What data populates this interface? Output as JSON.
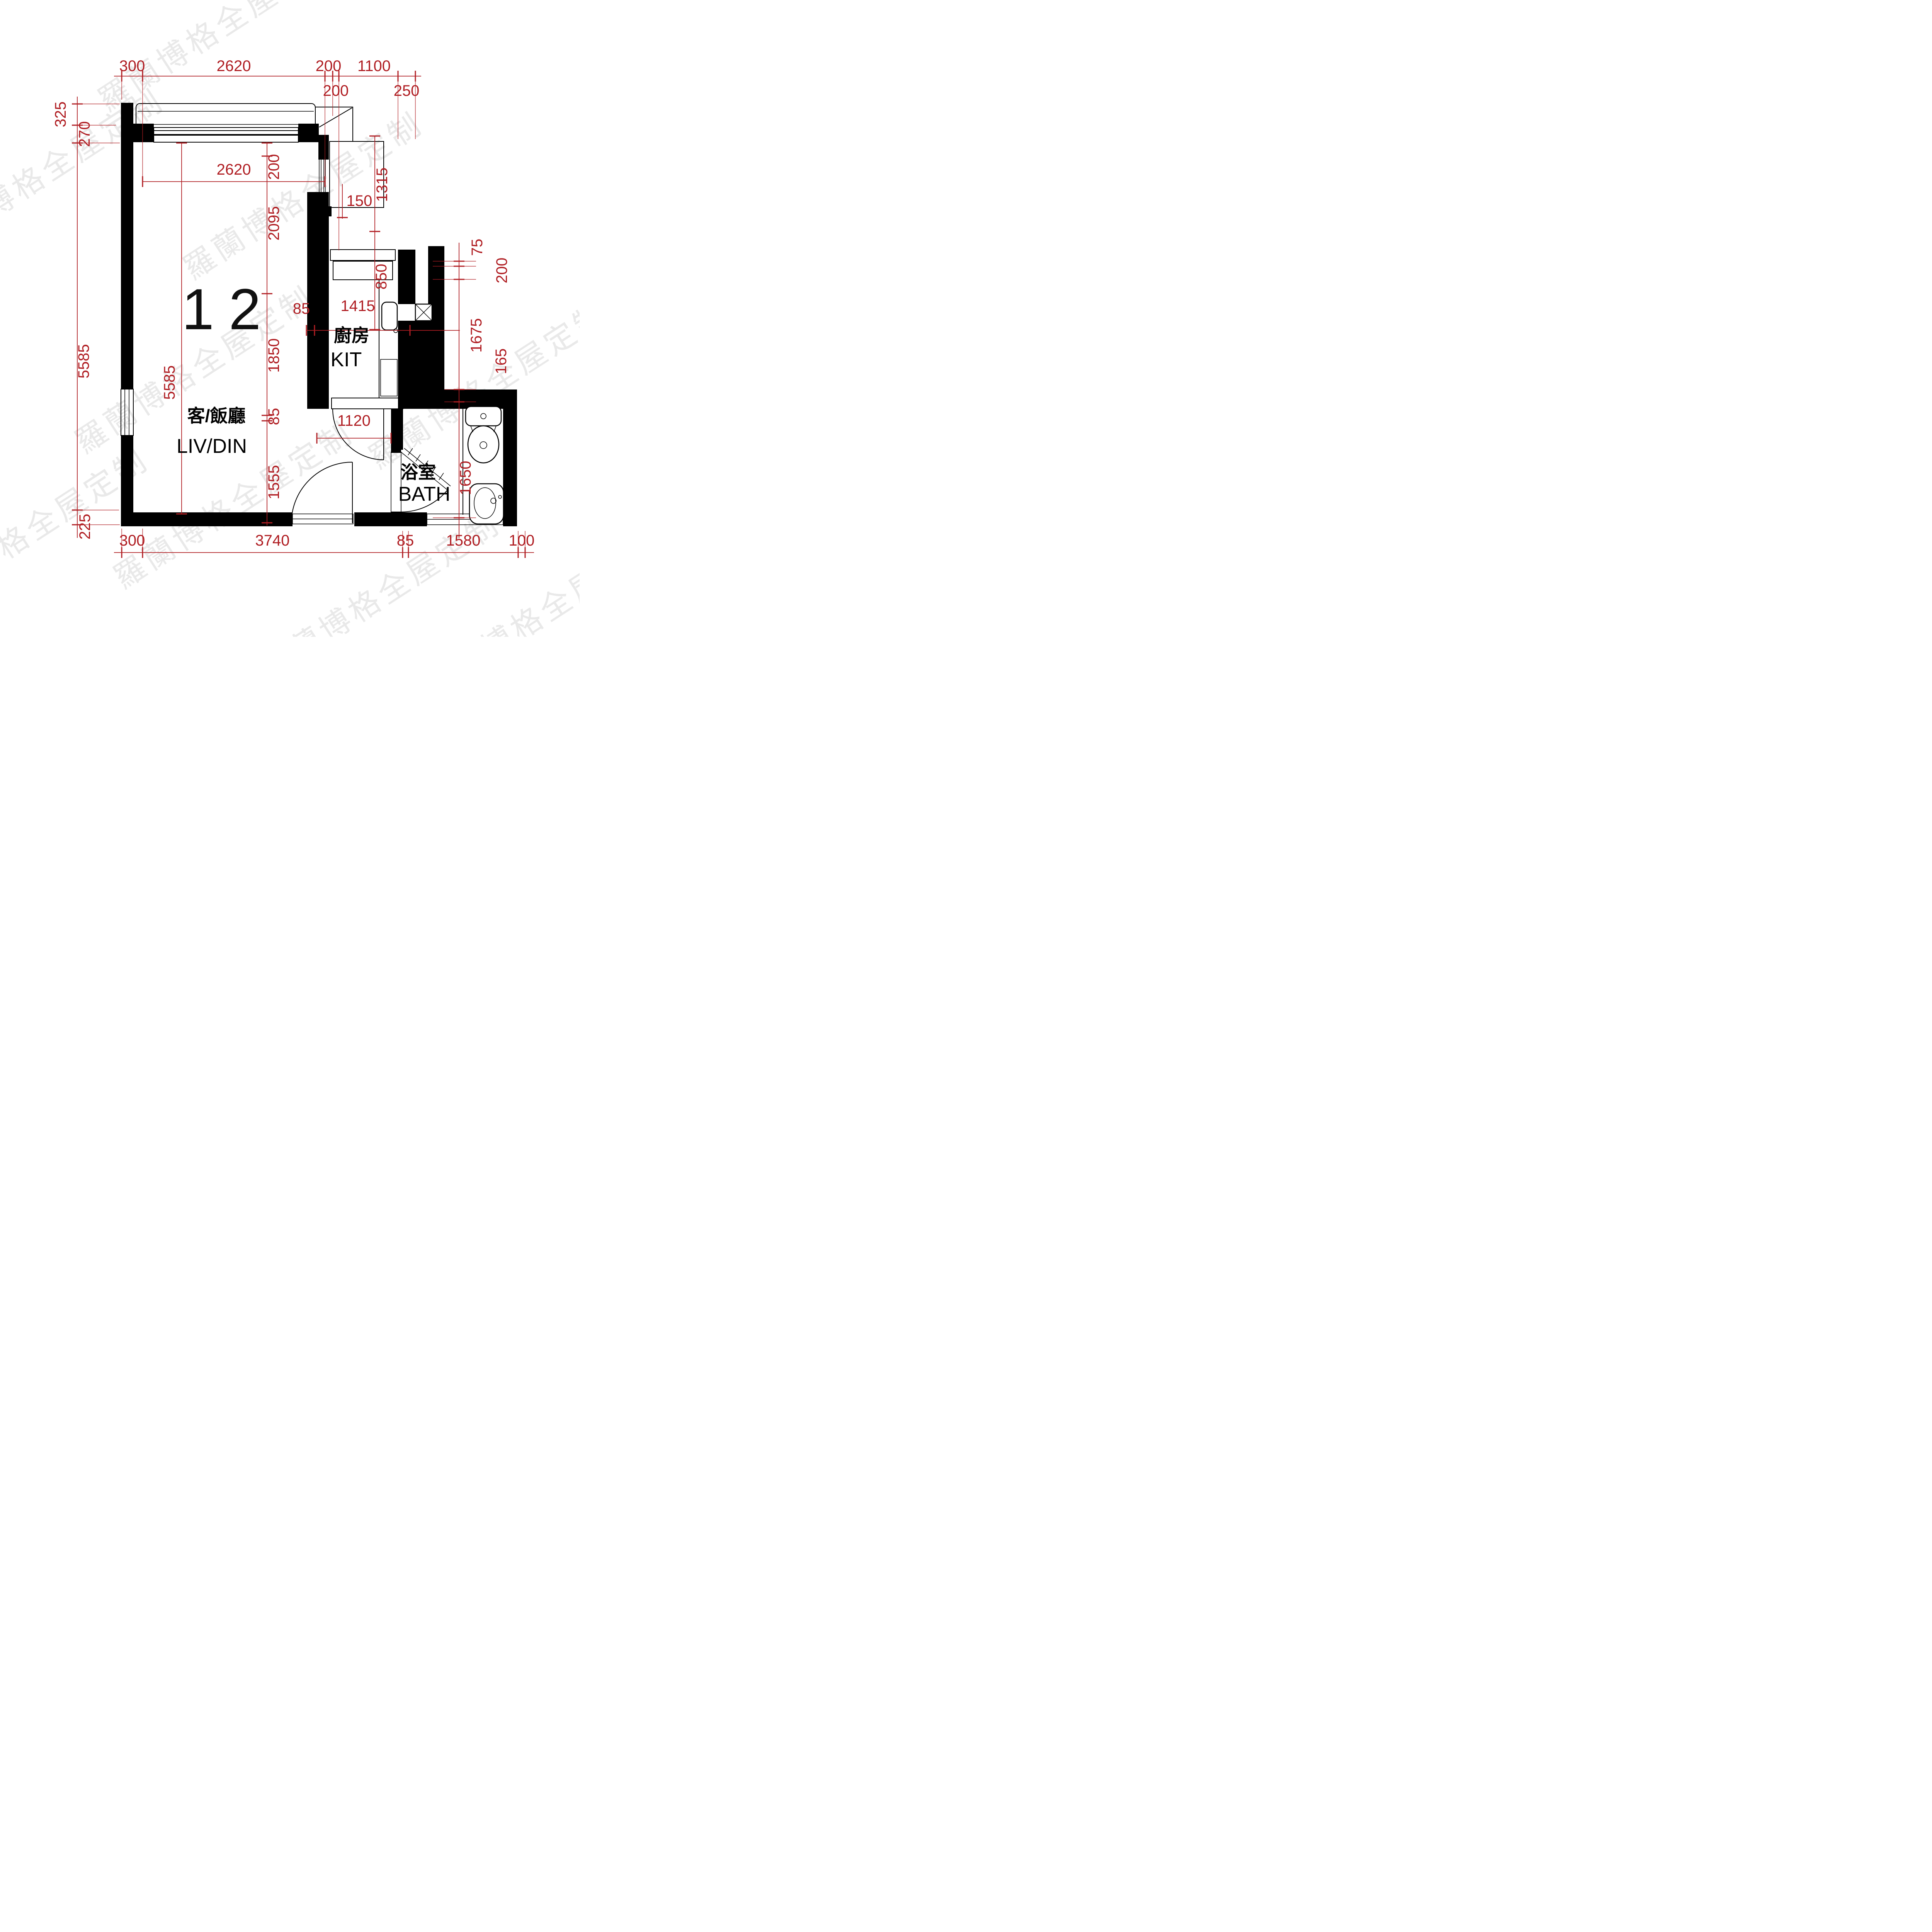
{
  "document": {
    "type": "apartment-floor-plan",
    "unit_number": "12"
  },
  "colors": {
    "dimension_red": "#b01e23",
    "walls": "#000000",
    "watermark_gray": "#d8d8d8",
    "background": "#ffffff"
  },
  "watermark": {
    "text": "羅蘭博格全屋定制"
  },
  "rooms": {
    "living": {
      "zh": "客/飯廳",
      "en": "LIV/DIN"
    },
    "kitchen": {
      "zh": "廚房",
      "en": "KIT"
    },
    "bath": {
      "zh": "浴室",
      "en": "BATH"
    }
  },
  "dimensions": {
    "top": [
      "300",
      "2620",
      "200",
      "1100"
    ],
    "top_offsets": [
      "200",
      "250"
    ],
    "left": [
      "325",
      "270",
      "5585",
      "225"
    ],
    "bottom": [
      "300",
      "3740",
      "85",
      "1580",
      "100"
    ],
    "right": [
      "75",
      "200",
      "1675",
      "165",
      "1650"
    ],
    "living_inner": {
      "width": "2620",
      "height": "5585",
      "chain": [
        "200",
        "2095",
        "1850",
        "85",
        "1555"
      ]
    },
    "kitchen": {
      "offset": "85",
      "width": "1415",
      "passage": "1120",
      "recess": "150"
    },
    "platform": {
      "height": "1315",
      "kitchen_window": "850"
    }
  }
}
